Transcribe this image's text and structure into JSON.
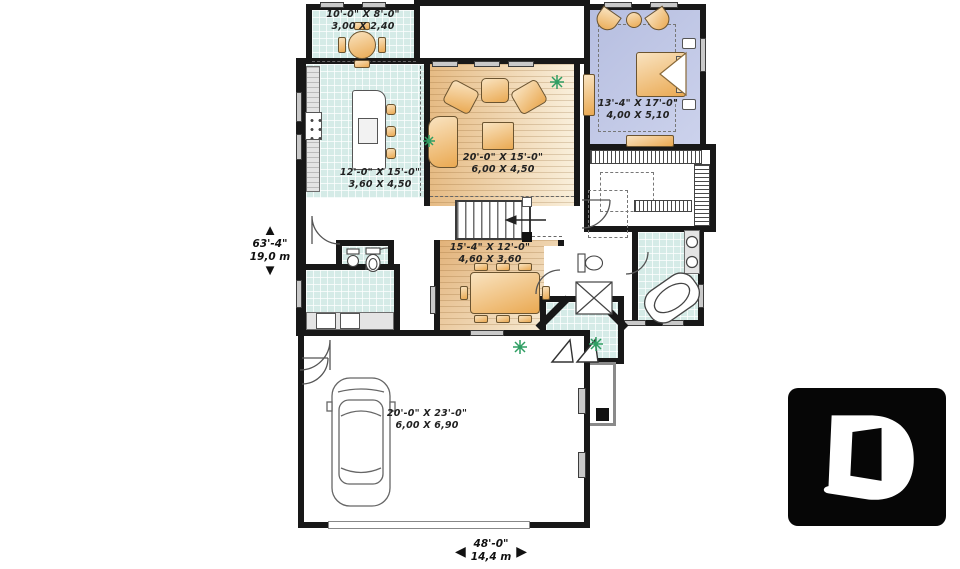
{
  "plan": {
    "rooms": [
      {
        "name": "breakfast-nook",
        "imperial": "10'-0\" X 8'-0\"",
        "metric": "3,00 X 2,40"
      },
      {
        "name": "kitchen",
        "imperial": "12'-0\" X 15'-0\"",
        "metric": "3,60 X 4,50"
      },
      {
        "name": "living-room",
        "imperial": "20'-0\" X 15'-0\"",
        "metric": "6,00 X 4,50"
      },
      {
        "name": "bedroom",
        "imperial": "13'-4\" X 17'-0\"",
        "metric": "4,00 X 5,10"
      },
      {
        "name": "dining-room",
        "imperial": "15'-4\" X 12'-0\"",
        "metric": "4,60 X 3,60"
      },
      {
        "name": "garage",
        "imperial": "20'-0\" X 23'-0\"",
        "metric": "6,00 X 6,90"
      }
    ],
    "overall_dimensions": {
      "depth": {
        "imperial": "63'-4\"",
        "metric": "19,0 m"
      },
      "width": {
        "imperial": "48'-0\"",
        "metric": "14,4 m"
      }
    }
  },
  "icons": {
    "arrow_up": "▲",
    "arrow_down": "▼",
    "arrow_left": "◀",
    "arrow_right": "▶",
    "plant": "plant-starburst",
    "logo_letter": "D"
  },
  "colors": {
    "wall": "#181818",
    "tile_floor": "#d5ebe7",
    "wood_floor": "#e6bb84",
    "bedroom_floor": "#b6bee0",
    "furniture": "#eaa952",
    "plant_green": "#2f9e63",
    "logo_background": "#060606",
    "logo_letter": "#ffffff"
  }
}
